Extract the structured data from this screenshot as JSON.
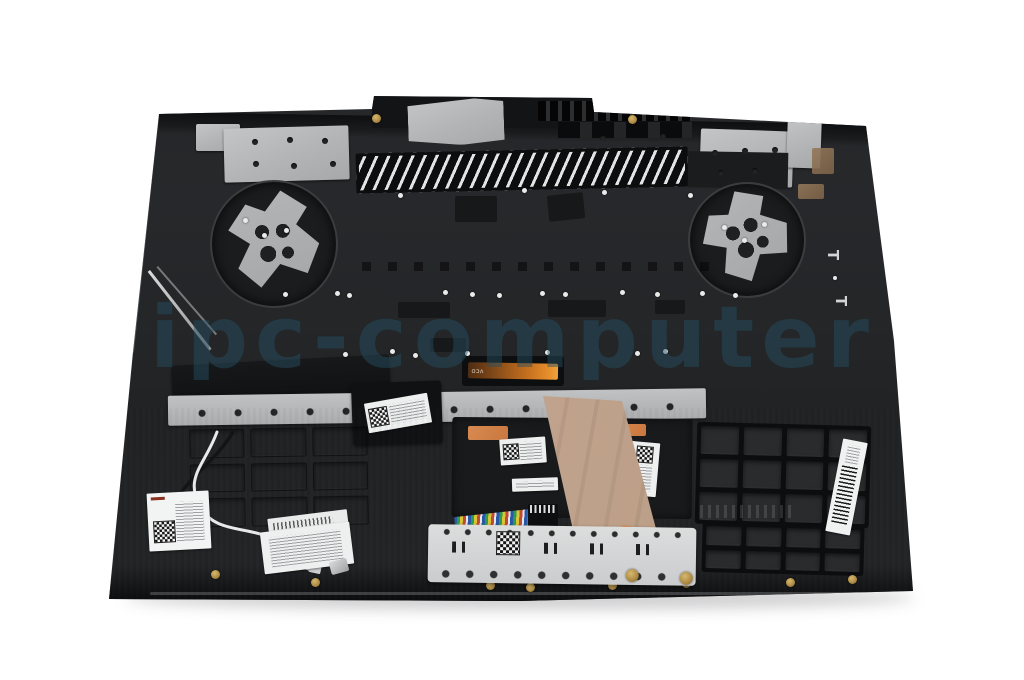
{
  "photo": {
    "type": "product-photo",
    "subject": "laptop top case palmrest assembly, internal rear view",
    "background_color": "#ffffff",
    "watermark": {
      "text": "ipc-computer",
      "color": "#265063"
    }
  },
  "molded_marks": {
    "t_upper": "T",
    "t_lower": "T"
  },
  "flex_cable_print": "VCO",
  "palette": {
    "case_black": "#1e2023",
    "keyboard_plate": "#25272a",
    "metal_plate_light": "#b9bbbc",
    "touchpad_bracket_silver": "#d6d7d8",
    "ribbon_cable_tan": "#c3a68f",
    "backlight_cable_orange": "#d07820",
    "screw_gold": "#b5924e",
    "copper_pad": "#8a6f52"
  },
  "stickers": {
    "keyboard_label": {
      "legible": false,
      "has_qr": true
    },
    "antenna_label": {
      "legible": false,
      "has_qr": true
    },
    "cable_label": {
      "legible": false,
      "has_barcode": true
    },
    "touchpad_board_labels": {
      "legible": false,
      "has_qr": true
    },
    "touchpad_bracket_label": {
      "legible": false,
      "has_qr": true
    },
    "right_side_label": {
      "legible": false,
      "has_barcode": true
    }
  }
}
